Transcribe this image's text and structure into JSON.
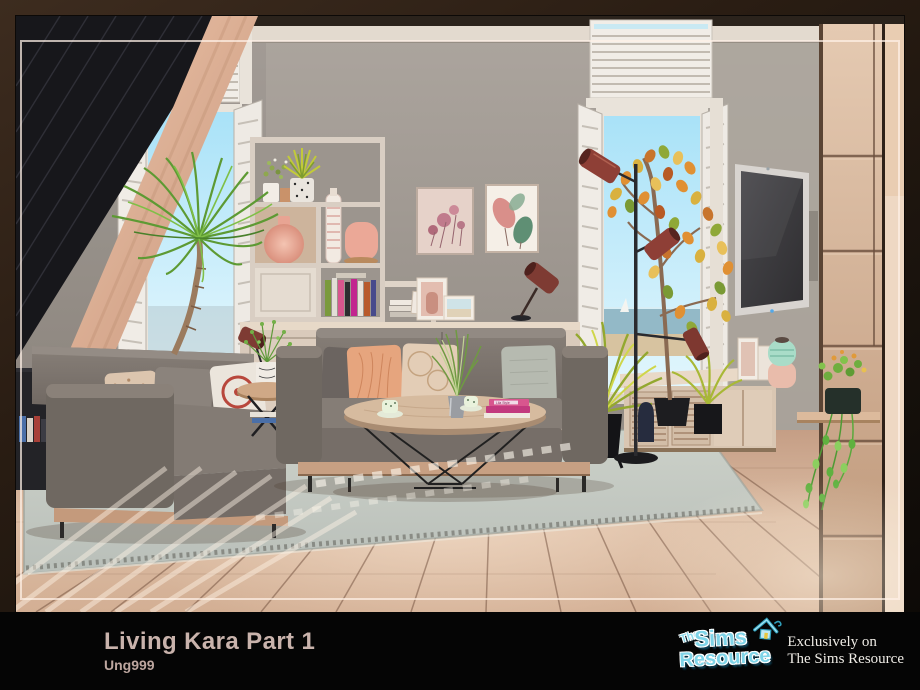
{
  "poster": {
    "title": "Living Kara Part 1",
    "creator": "Ung999",
    "brand_logo": {
      "prefix": "The",
      "word1": "Sims",
      "word2": "Resource",
      "icon": "tsr-house-icon"
    },
    "tagline": {
      "line1": "Exclusively on",
      "line2": "The Sims Resource"
    },
    "colors": {
      "caption_background": "#050505",
      "title_text": "#c9b3ac",
      "logo_fill": "#7fd4e8",
      "logo_shadow": "#0d4a63",
      "tagline_text": "#efece6",
      "frame_wood": "#2a1d13",
      "inner_border_line": "#fff1e7"
    }
  },
  "scene": {
    "book_spine_label": "Lila Style",
    "palette": {
      "wall_gray": "#a19a93",
      "ceiling_band": "#e3dacf",
      "floor_wood": "#d6b59e",
      "rug_gray_green": "#c6cac2",
      "sofa_gray": "#7d7670",
      "shelf_wood": "#d9cec3",
      "panel_wood": "#d3b094",
      "accent_lamp_red": "#8e3f36",
      "sky_blue": "#aee4f8",
      "plant_green": "#6fae3e",
      "vase_pink": "#edab9b",
      "vase_teal": "#a9dcc8"
    }
  }
}
